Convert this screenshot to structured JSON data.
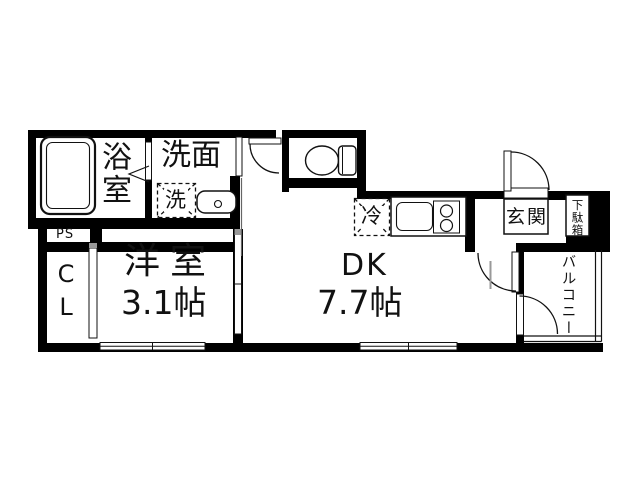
{
  "floor_plan": {
    "background": "#ffffff",
    "wall_color": "#000000",
    "line_color": "#111111",
    "gray_accent": "#999999",
    "labels": {
      "bathroom": "浴室",
      "washroom": "洗面",
      "washing_machine": "洗",
      "pipe_space": "PS",
      "closet": "CL",
      "western_room": "洋室",
      "western_room_size": "3.1帖",
      "dining_kitchen": "DK",
      "dining_kitchen_size": "7.7帖",
      "refrigerator": "冷",
      "entrance": "玄関",
      "shoe_cabinet": "下駄箱",
      "balcony": "バルコニー"
    }
  }
}
